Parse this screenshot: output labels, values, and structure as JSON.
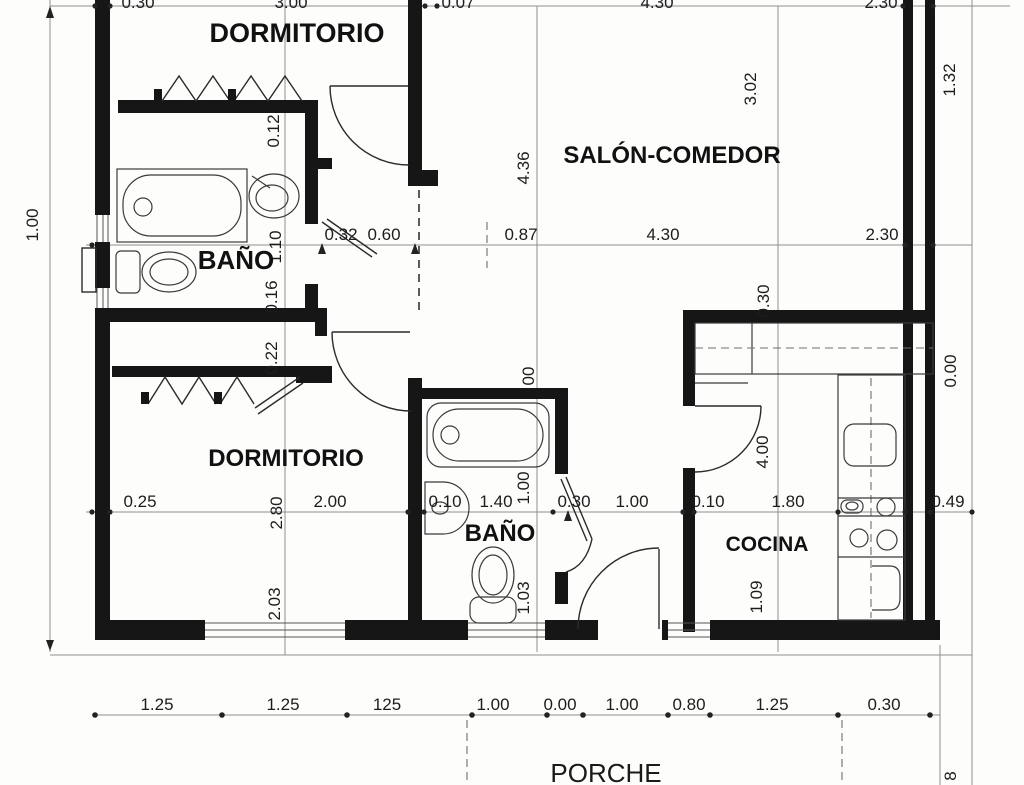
{
  "rooms": {
    "dormitorio_top": "DORMITORIO",
    "salon_comedor": "SALÓN-COMEDOR",
    "bano_top": "BAÑO",
    "dormitorio_bottom": "DORMITORIO",
    "bano_bottom": "BAÑO",
    "cocina": "COCINA",
    "porche": "PORCHE"
  },
  "dims": {
    "top": [
      "0.30",
      "3.00",
      "0.07",
      "4.30",
      "2.30"
    ],
    "mid": [
      "0.32",
      "0.60",
      "0.87",
      "4.30",
      "2.30"
    ],
    "lower": [
      "0.25",
      "2.00",
      "0.10",
      "1.40",
      "0.30",
      "1.00",
      "0.10",
      "1.80",
      "0.49"
    ],
    "bottom": [
      "1.25",
      "1.25",
      "125",
      "1.00",
      "0.00",
      "1.00",
      "0.80",
      "1.25",
      "0.30"
    ],
    "vleft": [
      "1.00"
    ],
    "vcol1": [
      "0.12",
      "1.10",
      "0.16",
      "0.22",
      "2.80",
      "2.03"
    ],
    "vcol2": [
      "4.36",
      "00",
      "1.00",
      "1.03"
    ],
    "vcol3": [
      "3.02",
      "0.30",
      "4.00",
      "1.09"
    ],
    "vcol4": [
      "1.32",
      "0.00",
      "8"
    ]
  }
}
